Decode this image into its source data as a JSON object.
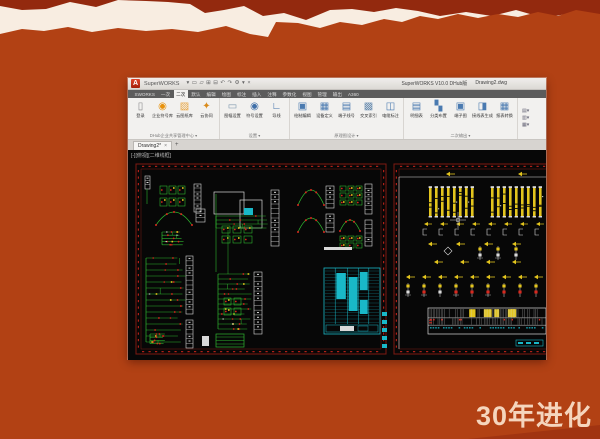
{
  "slide": {
    "background": "#b24114",
    "torn_top_color": "#93290e",
    "paper_color": "#f8ede1",
    "caption": "30年进化",
    "caption_color": "#f5d5bd"
  },
  "window": {
    "logo_letter": "A",
    "title_left": "SuperWORKS",
    "qat_icons": [
      "▾",
      "▭",
      "▱",
      "⊞",
      "⊟",
      "↶",
      "↷",
      "⚙",
      "▾",
      "×"
    ],
    "title_right_app": "SuperWORKS V10.0 DHub版",
    "title_right_doc": "Drawing2.dwg",
    "tabs": [
      {
        "label": "SWORKS",
        "active": false
      },
      {
        "label": "一次",
        "active": false
      },
      {
        "label": "二次",
        "active": true
      },
      {
        "label": "默认",
        "active": false
      },
      {
        "label": "编辑",
        "active": false
      },
      {
        "label": "绘图",
        "active": false
      },
      {
        "label": "标注",
        "active": false
      },
      {
        "label": "插入",
        "active": false
      },
      {
        "label": "注释",
        "active": false
      },
      {
        "label": "参数化",
        "active": false
      },
      {
        "label": "视图",
        "active": false
      },
      {
        "label": "管理",
        "active": false
      },
      {
        "label": "输出",
        "active": false
      },
      {
        "label": "A360",
        "active": false
      }
    ],
    "ribbon_groups": [
      {
        "name": "DHub企业共享管理中心",
        "items": [
          {
            "glyph": "▯",
            "color": "#8a8a8a",
            "label": "登录"
          },
          {
            "glyph": "◉",
            "color": "#e8920c",
            "label": "企业符号库"
          },
          {
            "glyph": "▨",
            "color": "#e8a33c",
            "label": "云图纸库"
          },
          {
            "glyph": "✦",
            "color": "#d98a1a",
            "label": "云协同"
          }
        ]
      },
      {
        "name": "设置",
        "items": [
          {
            "glyph": "▭",
            "color": "#7d97ad",
            "label": "图幅设置"
          },
          {
            "glyph": "◉",
            "color": "#3f6fa8",
            "label": "符号设置"
          },
          {
            "glyph": "∟",
            "color": "#3f6fa8",
            "label": "导线"
          }
        ]
      },
      {
        "name": "原理图设计",
        "items": [
          {
            "glyph": "▣",
            "color": "#4a7ab0",
            "label": "绘制编辑"
          },
          {
            "glyph": "▦",
            "color": "#4a7ab0",
            "label": "设备定义"
          },
          {
            "glyph": "▤",
            "color": "#4a7ab0",
            "label": "端子线号"
          },
          {
            "glyph": "▩",
            "color": "#6a8db0",
            "label": "交叉索引"
          },
          {
            "glyph": "◫",
            "color": "#4a7ab0",
            "label": "电缆标注"
          }
        ]
      },
      {
        "name": "二次输出",
        "items": [
          {
            "glyph": "▤",
            "color": "#4a7ab0",
            "label": "明细表"
          },
          {
            "glyph": "▚",
            "color": "#4a7ab0",
            "label": "分类布置"
          },
          {
            "glyph": "▣",
            "color": "#4a7ab0",
            "label": "端子图"
          },
          {
            "glyph": "◨",
            "color": "#4a7ab0",
            "label": "接线表生成"
          },
          {
            "glyph": "▦",
            "color": "#4a7ab0",
            "label": "报表转换"
          }
        ]
      }
    ],
    "ribbon_mini_icons": [
      "▤▾",
      "▥▾",
      "▦▾"
    ],
    "file_tab": {
      "label": "Drawing2*",
      "close": "×",
      "add": "+"
    }
  },
  "canvas": {
    "viewport_label": "[-][俯视][二维线框]",
    "colors": {
      "g": "#2fb52f",
      "r": "#d8281e",
      "y": "#e3c51d",
      "c": "#19b8c8",
      "w": "#d9d9d9",
      "f": "#7e1a12",
      "tick": "#c3241a"
    },
    "sheets": [
      {
        "frame": {
          "x": 8,
          "y": 14,
          "w": 250,
          "h": 190
        },
        "items": [
          {
            "t": "strip",
            "x": 17,
            "y": 26,
            "w": 5,
            "h": 13,
            "segs": 3
          },
          {
            "t": "line",
            "x1": 19,
            "y1": 39,
            "x2": 19,
            "y2": 54,
            "s": "g",
            "sw": 0.6
          },
          {
            "t": "grid",
            "x": 32,
            "y": 36,
            "rows": 2,
            "cols": 3,
            "cw": 7,
            "ch": 8,
            "gx": 2,
            "gy": 4
          },
          {
            "t": "strip",
            "x": 66,
            "y": 34,
            "w": 7,
            "h": 28,
            "segs": 7
          },
          {
            "t": "arc",
            "x": 28,
            "y": 62,
            "w": 36,
            "h": 13
          },
          {
            "t": "strip",
            "x": 68,
            "y": 59,
            "w": 9,
            "h": 13,
            "segs": 3
          },
          {
            "t": "ladder",
            "x": 34,
            "y": 82,
            "w": 22,
            "n": 5,
            "gap": 3.2
          },
          {
            "t": "ladder",
            "x": 18,
            "y": 108,
            "w": 40,
            "n": 15,
            "gap": 6
          },
          {
            "t": "strip",
            "x": 58,
            "y": 106,
            "w": 7,
            "h": 58,
            "segs": 12
          },
          {
            "t": "strip",
            "x": 58,
            "y": 170,
            "w": 7,
            "h": 28,
            "segs": 6
          },
          {
            "t": "rect",
            "x": 86,
            "y": 42,
            "w": 30,
            "h": 22,
            "s": "w"
          },
          {
            "t": "rect",
            "x": 112,
            "y": 50,
            "w": 22,
            "h": 28,
            "s": "w"
          },
          {
            "t": "rect",
            "x": 116,
            "y": 58,
            "w": 9,
            "h": 7,
            "f": "c"
          },
          {
            "t": "ladder",
            "x": 88,
            "y": 66,
            "w": 52,
            "n": 4,
            "gap": 4
          },
          {
            "t": "grid",
            "x": 94,
            "y": 76,
            "rows": 2,
            "cols": 3,
            "cw": 8,
            "ch": 7,
            "gx": 3,
            "gy": 3
          },
          {
            "t": "strip",
            "x": 143,
            "y": 40,
            "w": 8,
            "h": 56,
            "segs": 12
          },
          {
            "t": "line",
            "x1": 88,
            "y1": 44,
            "x2": 88,
            "y2": 122,
            "s": "g",
            "sw": 0.6
          },
          {
            "t": "line",
            "x1": 100,
            "y1": 80,
            "x2": 100,
            "y2": 124,
            "s": "g",
            "sw": 0.5
          },
          {
            "t": "ladder",
            "x": 90,
            "y": 124,
            "w": 34,
            "n": 12,
            "gap": 5
          },
          {
            "t": "strip",
            "x": 126,
            "y": 122,
            "w": 8,
            "h": 62,
            "segs": 13
          },
          {
            "t": "grid",
            "x": 96,
            "y": 148,
            "rows": 2,
            "cols": 2,
            "cw": 7,
            "ch": 7,
            "gx": 3,
            "gy": 3
          },
          {
            "t": "arc",
            "x": 170,
            "y": 40,
            "w": 26,
            "h": 15
          },
          {
            "t": "strip",
            "x": 198,
            "y": 36,
            "w": 8,
            "h": 22,
            "segs": 5
          },
          {
            "t": "arc",
            "x": 170,
            "y": 68,
            "w": 26,
            "h": 14
          },
          {
            "t": "strip",
            "x": 198,
            "y": 64,
            "w": 8,
            "h": 18,
            "segs": 4
          },
          {
            "t": "grid",
            "x": 212,
            "y": 36,
            "rows": 3,
            "cols": 3,
            "cw": 6,
            "ch": 5,
            "gx": 2,
            "gy": 2
          },
          {
            "t": "strip",
            "x": 237,
            "y": 34,
            "w": 7,
            "h": 30,
            "segs": 7
          },
          {
            "t": "arc",
            "x": 212,
            "y": 70,
            "w": 20,
            "h": 11
          },
          {
            "t": "grid",
            "x": 212,
            "y": 86,
            "rows": 2,
            "cols": 3,
            "cw": 6,
            "ch": 5,
            "gx": 2,
            "gy": 2
          },
          {
            "t": "strip",
            "x": 237,
            "y": 70,
            "w": 7,
            "h": 26,
            "segs": 6
          },
          {
            "t": "label",
            "x": 196,
            "y": 97,
            "w": 28,
            "h": 3,
            "f": "w"
          },
          {
            "t": "cyantable",
            "x": 196,
            "y": 118,
            "w": 56,
            "h": 66
          },
          {
            "t": "tickscol",
            "x": 254,
            "y": 162,
            "n": 5,
            "gap": 8
          },
          {
            "t": "ladder",
            "x": 22,
            "y": 184,
            "w": 16,
            "n": 4,
            "gap": 3.2
          },
          {
            "t": "label",
            "x": 74,
            "y": 186,
            "w": 7,
            "h": 10,
            "f": "w"
          },
          {
            "t": "rect",
            "x": 88,
            "y": 184,
            "w": 28,
            "h": 13,
            "s": "g"
          },
          {
            "t": "hlines",
            "x": 88,
            "y": 187,
            "w": 28,
            "n": 3,
            "gap": 3.5,
            "s": "g"
          }
        ]
      },
      {
        "frame": {
          "x": 266,
          "y": 14,
          "w": 158,
          "h": 190
        },
        "items": [
          {
            "t": "line",
            "x1": 271,
            "y1": 27,
            "x2": 418,
            "y2": 27,
            "s": "w",
            "sw": 0.6
          },
          {
            "t": "line",
            "x1": 271,
            "y1": 27,
            "x2": 271,
            "y2": 199,
            "s": "w",
            "sw": 0.6
          },
          {
            "t": "arrows",
            "x": 318,
            "y": 24,
            "n": 1,
            "gap": 16
          },
          {
            "t": "arrows",
            "x": 390,
            "y": 24,
            "n": 1,
            "gap": 16
          },
          {
            "t": "ybars",
            "x": 301,
            "y": 38,
            "n": 8,
            "gap": 6,
            "h": 28
          },
          {
            "t": "ybars",
            "x": 363,
            "y": 38,
            "n": 9,
            "gap": 6,
            "h": 28
          },
          {
            "t": "symbolrow",
            "x": 296,
            "y": 74,
            "n": 8,
            "gap": 16
          },
          {
            "t": "cross",
            "x": 330,
            "y": 70
          },
          {
            "t": "arrows",
            "x": 300,
            "y": 94,
            "n": 4,
            "gap": 28
          },
          {
            "t": "diamond",
            "x": 320,
            "y": 101
          },
          {
            "t": "comprow",
            "x": 352,
            "y": 96,
            "n": 3,
            "gap": 18
          },
          {
            "t": "arrows",
            "x": 306,
            "y": 112,
            "n": 4,
            "gap": 26
          },
          {
            "t": "arrows",
            "x": 278,
            "y": 127,
            "n": 9,
            "gap": 16
          },
          {
            "t": "comprow",
            "x": 280,
            "y": 133,
            "n": 9,
            "gap": 16
          },
          {
            "t": "hstrip",
            "x": 300,
            "y": 158,
            "w": 118,
            "h": 26
          },
          {
            "t": "cyanlabel",
            "x": 388,
            "y": 190,
            "w": 27,
            "h": 6
          }
        ]
      }
    ]
  }
}
